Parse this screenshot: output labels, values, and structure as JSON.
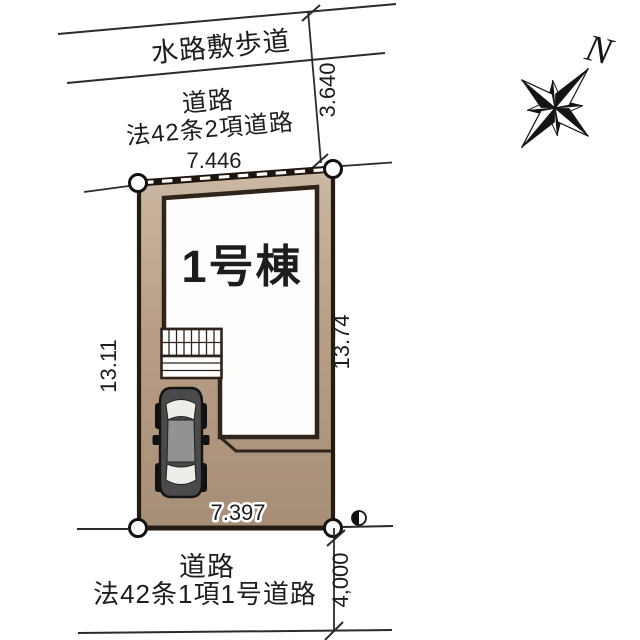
{
  "lot": {
    "building_label": "1号棟",
    "dim_top": "7.446",
    "dim_bottom": "7.397",
    "dim_left": "13.11",
    "dim_right": "13.74"
  },
  "roads": {
    "waterway": "水路敷歩道",
    "top_label1": "道路",
    "top_label2": "法42条2項道路",
    "top_setback": "3.640",
    "bottom_label1": "道路",
    "bottom_label2": "法42条1項1号道路",
    "bottom_width": "4,000"
  },
  "compass": {
    "north": "N"
  },
  "colors": {
    "lot_fill": "#b89e86",
    "lot_fill_light": "#ccb8a3",
    "lot_fill_dark": "#a78e76",
    "outline_dark": "#241b13",
    "line_black": "#2b2b2b",
    "car_body": "#4a4a4a",
    "car_roof": "#929292"
  }
}
